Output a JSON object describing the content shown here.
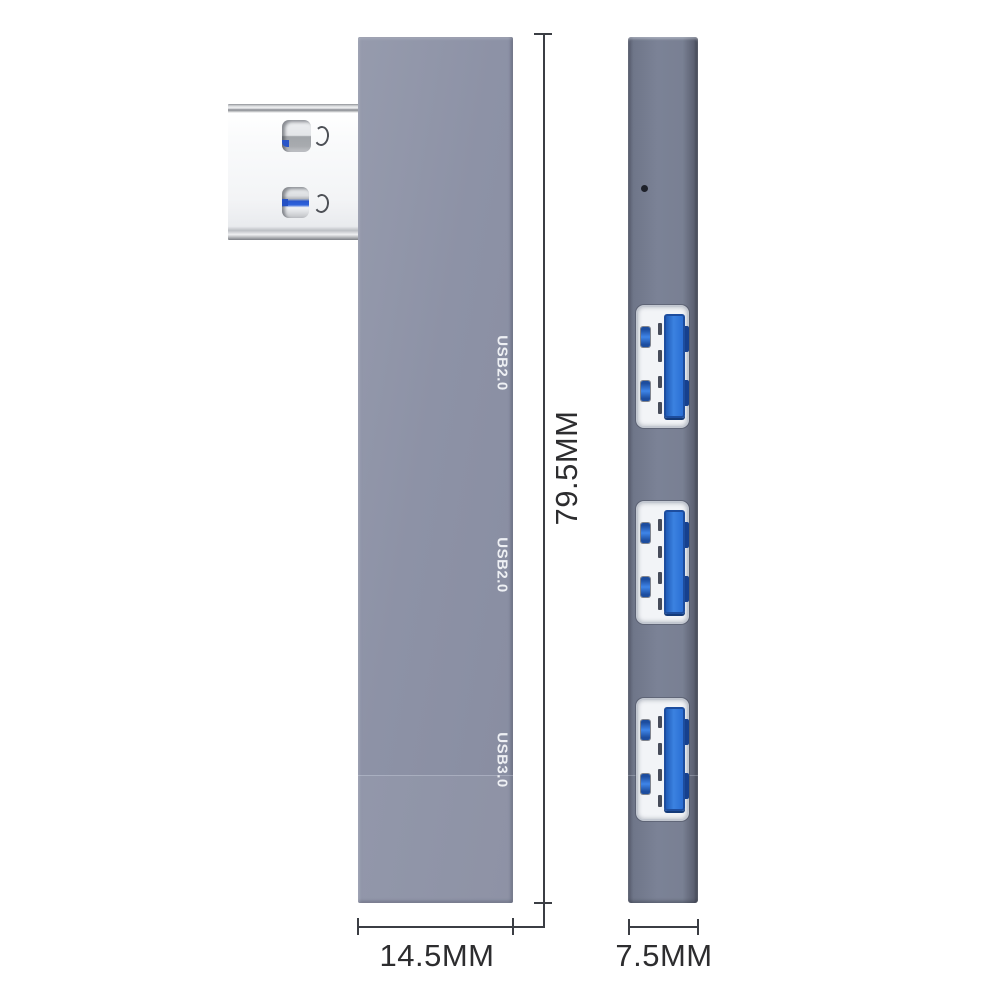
{
  "front_view": {
    "port_labels": [
      "USB2.0",
      "USB2.0",
      "USB3.0"
    ]
  },
  "side_view": {
    "port_count": 3,
    "led_indicator": true
  },
  "dimensions": {
    "height": "79.5MM",
    "width": "14.5MM",
    "depth": "7.5MM"
  },
  "colors": {
    "front_body": "#8d92a6",
    "side_body": "#7b8296",
    "usb_tongue_blue": "#2e74d8",
    "connector_metal": "#f3f4f6",
    "dimension_line": "#3b3e44",
    "dimension_text": "#2d2d2f",
    "port_label_text": "#eef0f4",
    "background": "#ffffff"
  }
}
